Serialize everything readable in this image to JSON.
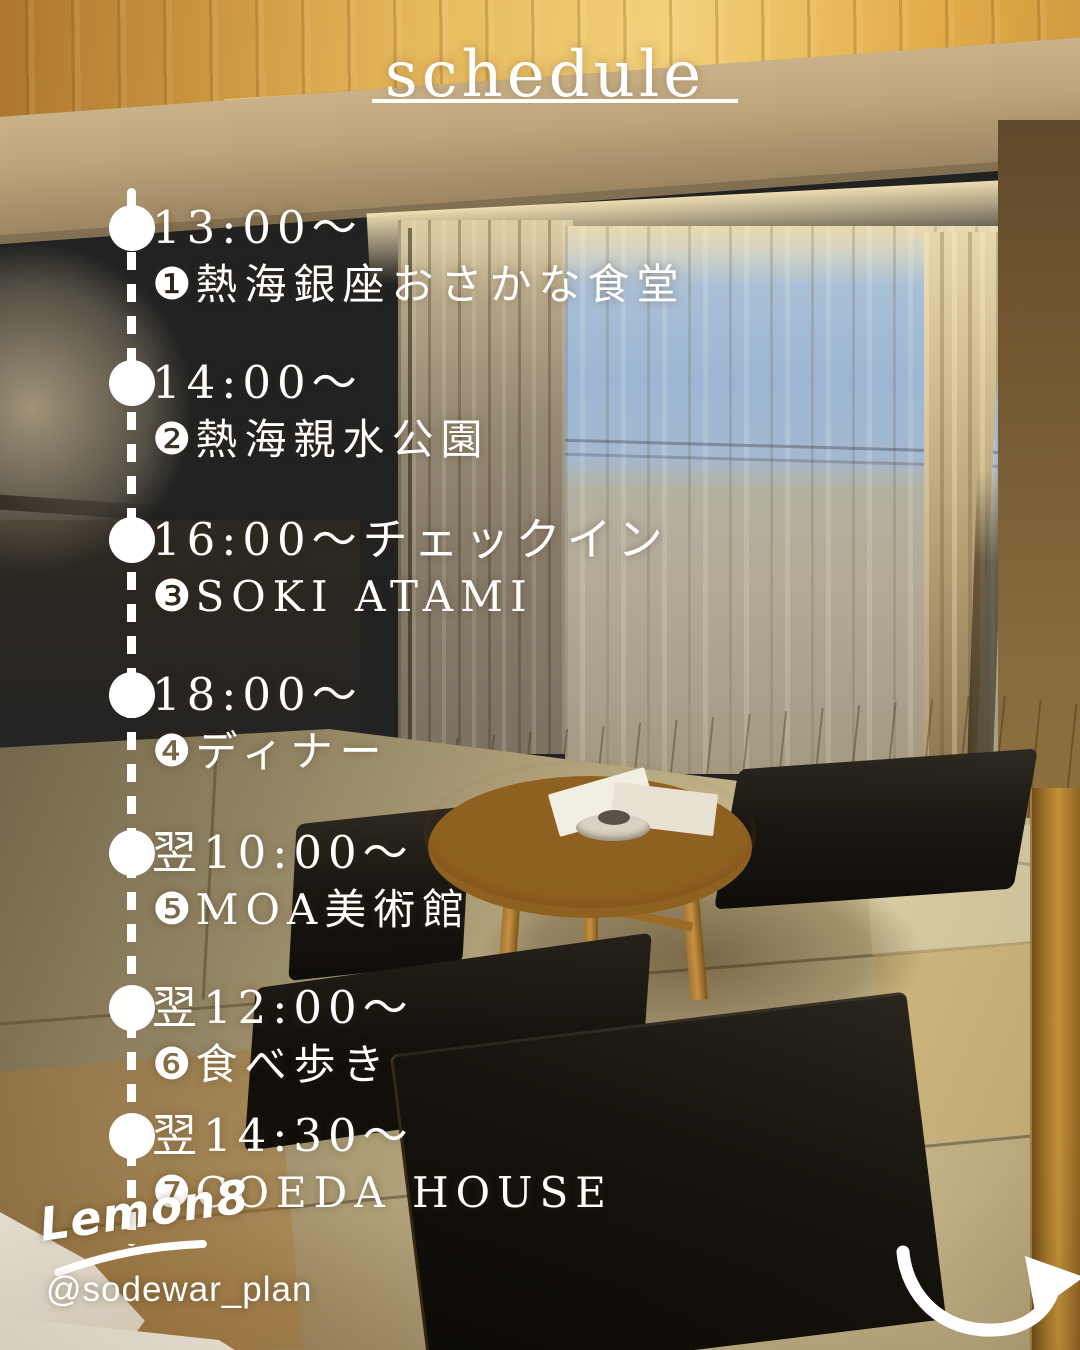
{
  "title": {
    "text": "schedule"
  },
  "timeline": {
    "items": [
      {
        "time": "13:00〜",
        "number": "❶",
        "place": "熱海銀座おさかな食堂"
      },
      {
        "time": "14:00〜",
        "number": "❷",
        "place": "熱海親水公園"
      },
      {
        "time": "16:00〜チェックイン",
        "number": "❸",
        "place": "SOKI ATAMI"
      },
      {
        "time": "18:00〜",
        "number": "❹",
        "place": "ディナー"
      },
      {
        "time": "翌10:00〜",
        "number": "❺",
        "place": "MOA美術館"
      },
      {
        "time": "翌12:00〜",
        "number": "❻",
        "place": "食べ歩き"
      },
      {
        "time": "翌14:30〜",
        "number": "❼",
        "place": "COEDA HOUSE"
      }
    ]
  },
  "footer": {
    "brand": "Lemon8",
    "username": "@sodewar_plan"
  },
  "icons": {
    "arrow": "curved-swoosh-arrow-right",
    "timeline_dot": "white-circle",
    "timeline_line": "white-dashed-vertical"
  },
  "colors": {
    "text": "#ffffff",
    "ceiling_gold": "#e8b95a",
    "wall_tan": "#8a7354",
    "window_sky_blue": "#9cb6d3",
    "curtain_beige": "#c9b88f",
    "tatami_khaki": "#c2b389",
    "table_wood": "#c28c3a",
    "cushion_black": "#17130e"
  },
  "scene_description": "Japanese-style hotel room at dusk with round low wooden table, black floor cushions, tatami mats and sheer curtained window"
}
